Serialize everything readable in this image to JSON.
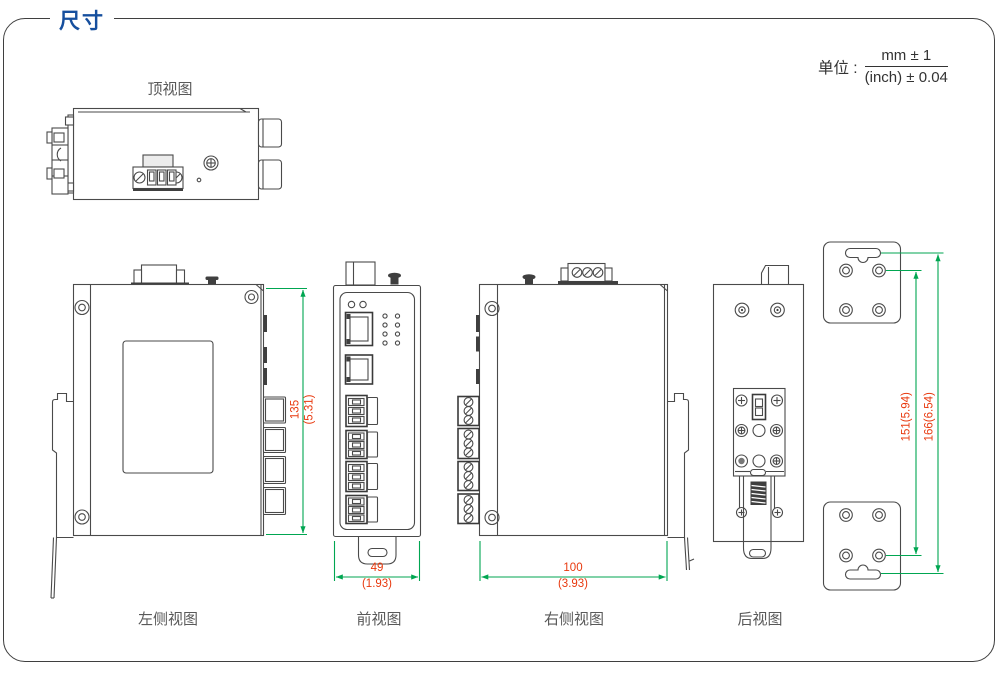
{
  "page": {
    "title": "尺寸"
  },
  "unit": {
    "label": "单位 :",
    "numerator": "mm ± 1",
    "denominator": "(inch) ± 0.04"
  },
  "views": {
    "top": {
      "label": "顶视图"
    },
    "left_side": {
      "label": "左侧视图"
    },
    "front": {
      "label": "前视图"
    },
    "right_side": {
      "label": "右侧视图"
    },
    "rear": {
      "label": "后视图"
    }
  },
  "dimensions": {
    "height": {
      "mm": "135",
      "inch": "(5.31)"
    },
    "front_width": {
      "mm": "49",
      "inch": "(1.93)"
    },
    "side_width": {
      "mm": "100",
      "inch": "(3.93)"
    },
    "bracket_hole_spacing": {
      "text": "151(5.94)"
    },
    "bracket_slot_spacing": {
      "text": "166(6.54)"
    }
  },
  "colors": {
    "title_blue": "#164f9e",
    "outline_gray": "#4a4a4a",
    "dimension_green": "#00a651",
    "dimension_red": "#e8380d",
    "label_gray": "#595959"
  }
}
